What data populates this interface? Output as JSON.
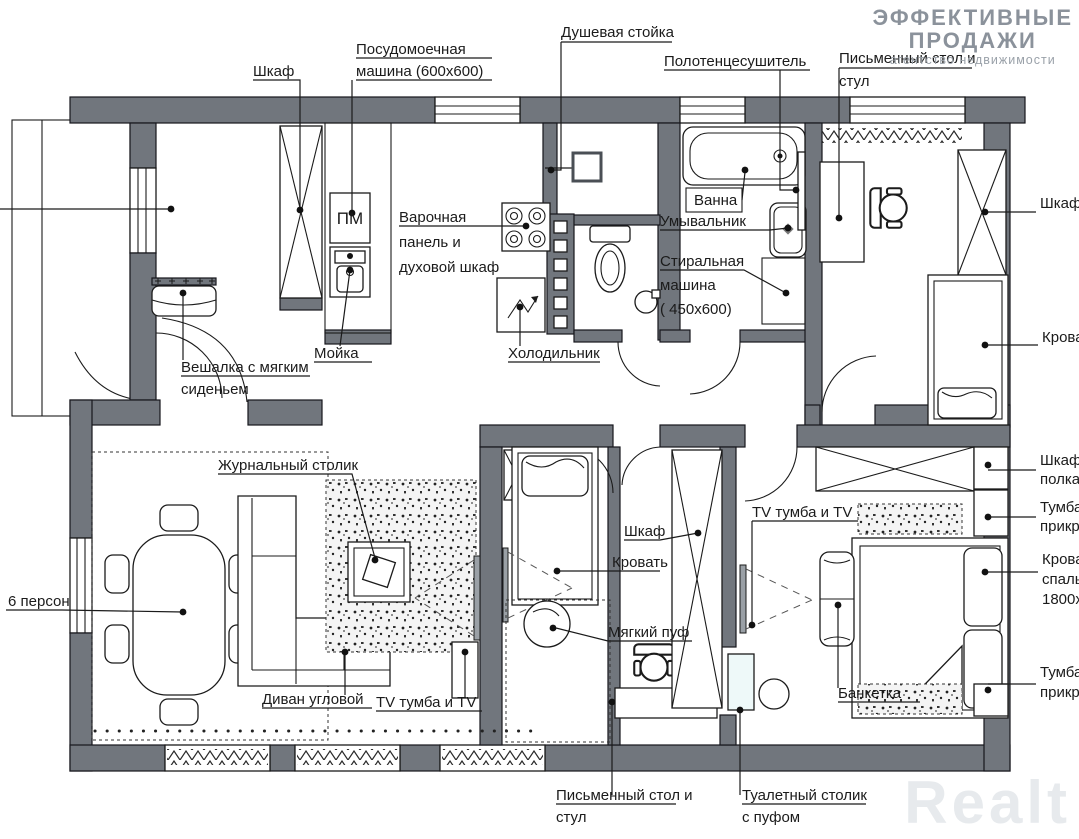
{
  "branding": {
    "logo_line1": "ЭФФЕКТИВНЫЕ",
    "logo_line2": "ПРОДАЖИ",
    "logo_subtitle": "агентство недвижимости",
    "watermark": "Realt"
  },
  "colors": {
    "wall": "#71767d",
    "line": "#1b1b1b",
    "logo_gray": "#8b929b",
    "watermark_gray": "#e7eaed"
  },
  "labels": {
    "wardrobe_top": "Шкаф",
    "dishwasher_l1": "Посудомоечная",
    "dishwasher_l2": "машина (600х600)",
    "shower_stand": "Душевая стойка",
    "towel_dryer": "Полотенцесушитель",
    "desk_top_l1": "Письменный стол и",
    "desk_top_l2": "стул",
    "pm": "ПМ",
    "hob_l1": "Варочная",
    "hob_l2": "панель и",
    "hob_l3": "духовой шкаф",
    "sink_kitchen": "Мойка",
    "fridge": "Холодильник",
    "bath": "Ванна",
    "washbasin": "Умывальник",
    "washer_l1": "Стиральная",
    "washer_l2": "машина",
    "washer_l3": "( 450х600)",
    "hanger_l1": "Вешалка с мягким",
    "hanger_l2": "сиденьем",
    "persons6": "6 персон",
    "coffee_table": "Журнальный столик",
    "sofa_corner": "Диван угловой",
    "tv_living": "TV тумба и TV",
    "wardrobe_mid": "Шкаф",
    "bed_mid": "Кровать",
    "pouf": "Мягкий пуф",
    "desk_bottom_l1": "Письменный стол и",
    "desk_bottom_l2": "стул",
    "dressing_l1": "Туалетный столик",
    "dressing_l2": "с пуфом",
    "tv_master": "TV тумба и TV",
    "bench": "Банкетка",
    "r_wardrobe": "Шкаф",
    "r_bed": "Крова",
    "r_shelf_l1": "Шкаф",
    "r_shelf_l2": "полка",
    "r_tumba1_l1": "Тумба",
    "r_tumba1_l2": "прикр",
    "r_bed2_l1": "Крова",
    "r_bed2_l2": "спаль",
    "r_bed2_l3": "1800х",
    "r_tumba2_l1": "Тумба",
    "r_tumba2_l2": "прикр"
  }
}
